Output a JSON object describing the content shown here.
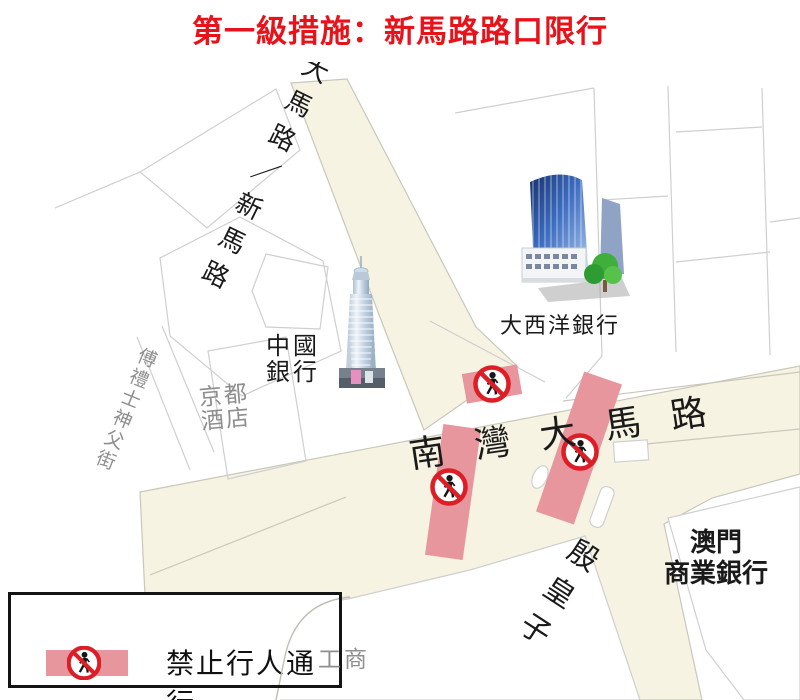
{
  "title": "第一級措施：新馬路路口限行",
  "map": {
    "roads": {
      "san_ma_lo": "大馬路／新馬路",
      "nam_van": "南灣大馬路",
      "infante": "殷皇子"
    },
    "places": {
      "boc": [
        "中國",
        "銀行"
      ],
      "bnu": "大西洋銀行",
      "mcb": [
        "澳門",
        "商業銀行"
      ],
      "hotel": [
        "京都",
        "酒店"
      ],
      "street": "傅禮士神父街",
      "background_text": "工商"
    },
    "restriction_icon": "no-pedestrian-icon"
  },
  "legend": {
    "label": "禁止行人通行"
  },
  "colors": {
    "accent_red": "#e8121a",
    "road_fill": "#f6f3e2",
    "restriction_pink": "#e7969e",
    "sign_red": "#dd1e26",
    "block_outline": "#cfcfcf",
    "gray_label": "#8e8e8e"
  }
}
